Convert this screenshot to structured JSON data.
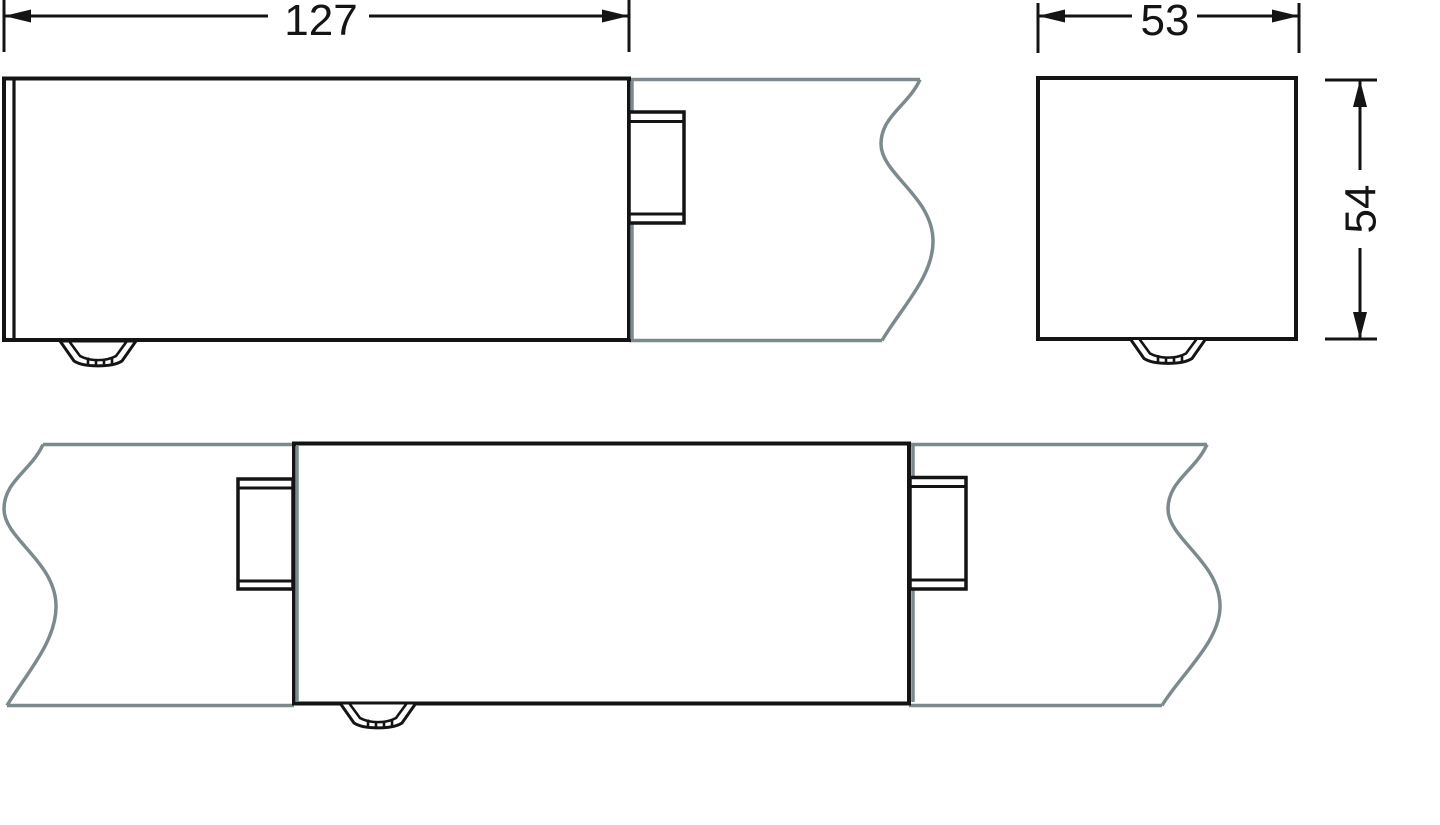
{
  "drawing": {
    "type": "technical-dimension-drawing",
    "colors": {
      "object_line": "#141414",
      "phantom_line": "#7d8a8d",
      "background": "#ffffff"
    },
    "dimensions": {
      "length": {
        "value": "127"
      },
      "width": {
        "value": "53"
      },
      "height": {
        "value": "54"
      }
    }
  }
}
